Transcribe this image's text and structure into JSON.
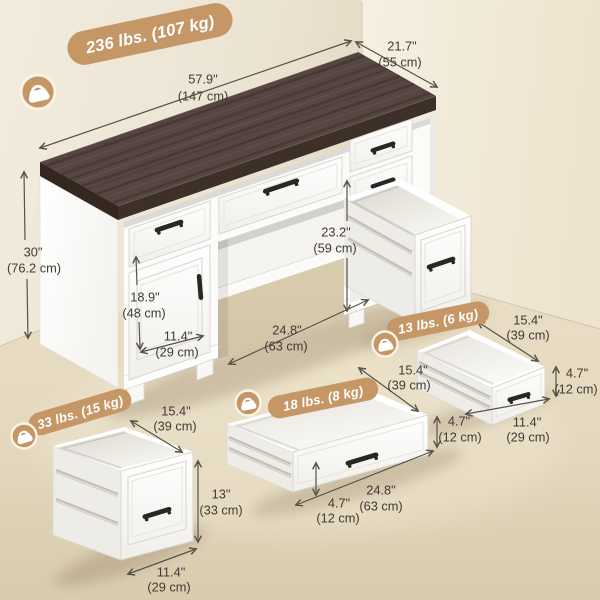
{
  "scene": {
    "colors": {
      "accent_tan": "#C59766",
      "wood_top": "#54433A",
      "left_wall": "#EFE8DA",
      "right_wall": "#F3ECDC",
      "floor": "#E7DCC3",
      "furniture_white": "#FDFDFC",
      "dimension_text": "#3E3B37"
    },
    "icons": {
      "weight_badge_icon": "weight-icon"
    }
  },
  "badges": {
    "total_weight": {
      "label": "236 lbs. (107 kg)",
      "icon": "weight-icon"
    },
    "file_drawer_weight": {
      "label": "33 lbs. (15 kg)",
      "icon": "weight-icon"
    },
    "wide_drawer_weight": {
      "label": "18 lbs. (8 kg)",
      "icon": "weight-icon"
    },
    "small_drawer_weight": {
      "label": "13 lbs. (6 kg)",
      "icon": "weight-icon"
    }
  },
  "dimensions": {
    "desk_width": {
      "in": "57.9\"",
      "cm": "(147 cm)"
    },
    "desk_depth": {
      "in": "21.7\"",
      "cm": "(55 cm)"
    },
    "desk_height": {
      "in": "30\"",
      "cm": "(76.2 cm)"
    },
    "door_height": {
      "in": "18.9\"",
      "cm": "(48 cm)"
    },
    "door_width": {
      "in": "11.4\"",
      "cm": "(29 cm)"
    },
    "knee_width": {
      "in": "24.8\"",
      "cm": "(63 cm)"
    },
    "knee_height": {
      "in": "23.2\"",
      "cm": "(59 cm)"
    },
    "file_drawer_depth": {
      "in": "15.4\"",
      "cm": "(39 cm)"
    },
    "file_drawer_height": {
      "in": "13\"",
      "cm": "(33 cm)"
    },
    "file_drawer_width": {
      "in": "11.4\"",
      "cm": "(29 cm)"
    },
    "wide_drawer_depth": {
      "in": "15.4\"",
      "cm": "(39 cm)"
    },
    "wide_drawer_height_right": {
      "in": "4.7\"",
      "cm": "(12 cm)"
    },
    "wide_drawer_height_left": {
      "in": "4.7\"",
      "cm": "(12 cm)"
    },
    "wide_drawer_width": {
      "in": "24.8\"",
      "cm": "(63 cm)"
    },
    "small_drawer_depth": {
      "in": "15.4\"",
      "cm": "(39 cm)"
    },
    "small_drawer_height": {
      "in": "4.7\"",
      "cm": "(12 cm)"
    },
    "small_drawer_width": {
      "in": "11.4\"",
      "cm": "(29 cm)"
    }
  }
}
